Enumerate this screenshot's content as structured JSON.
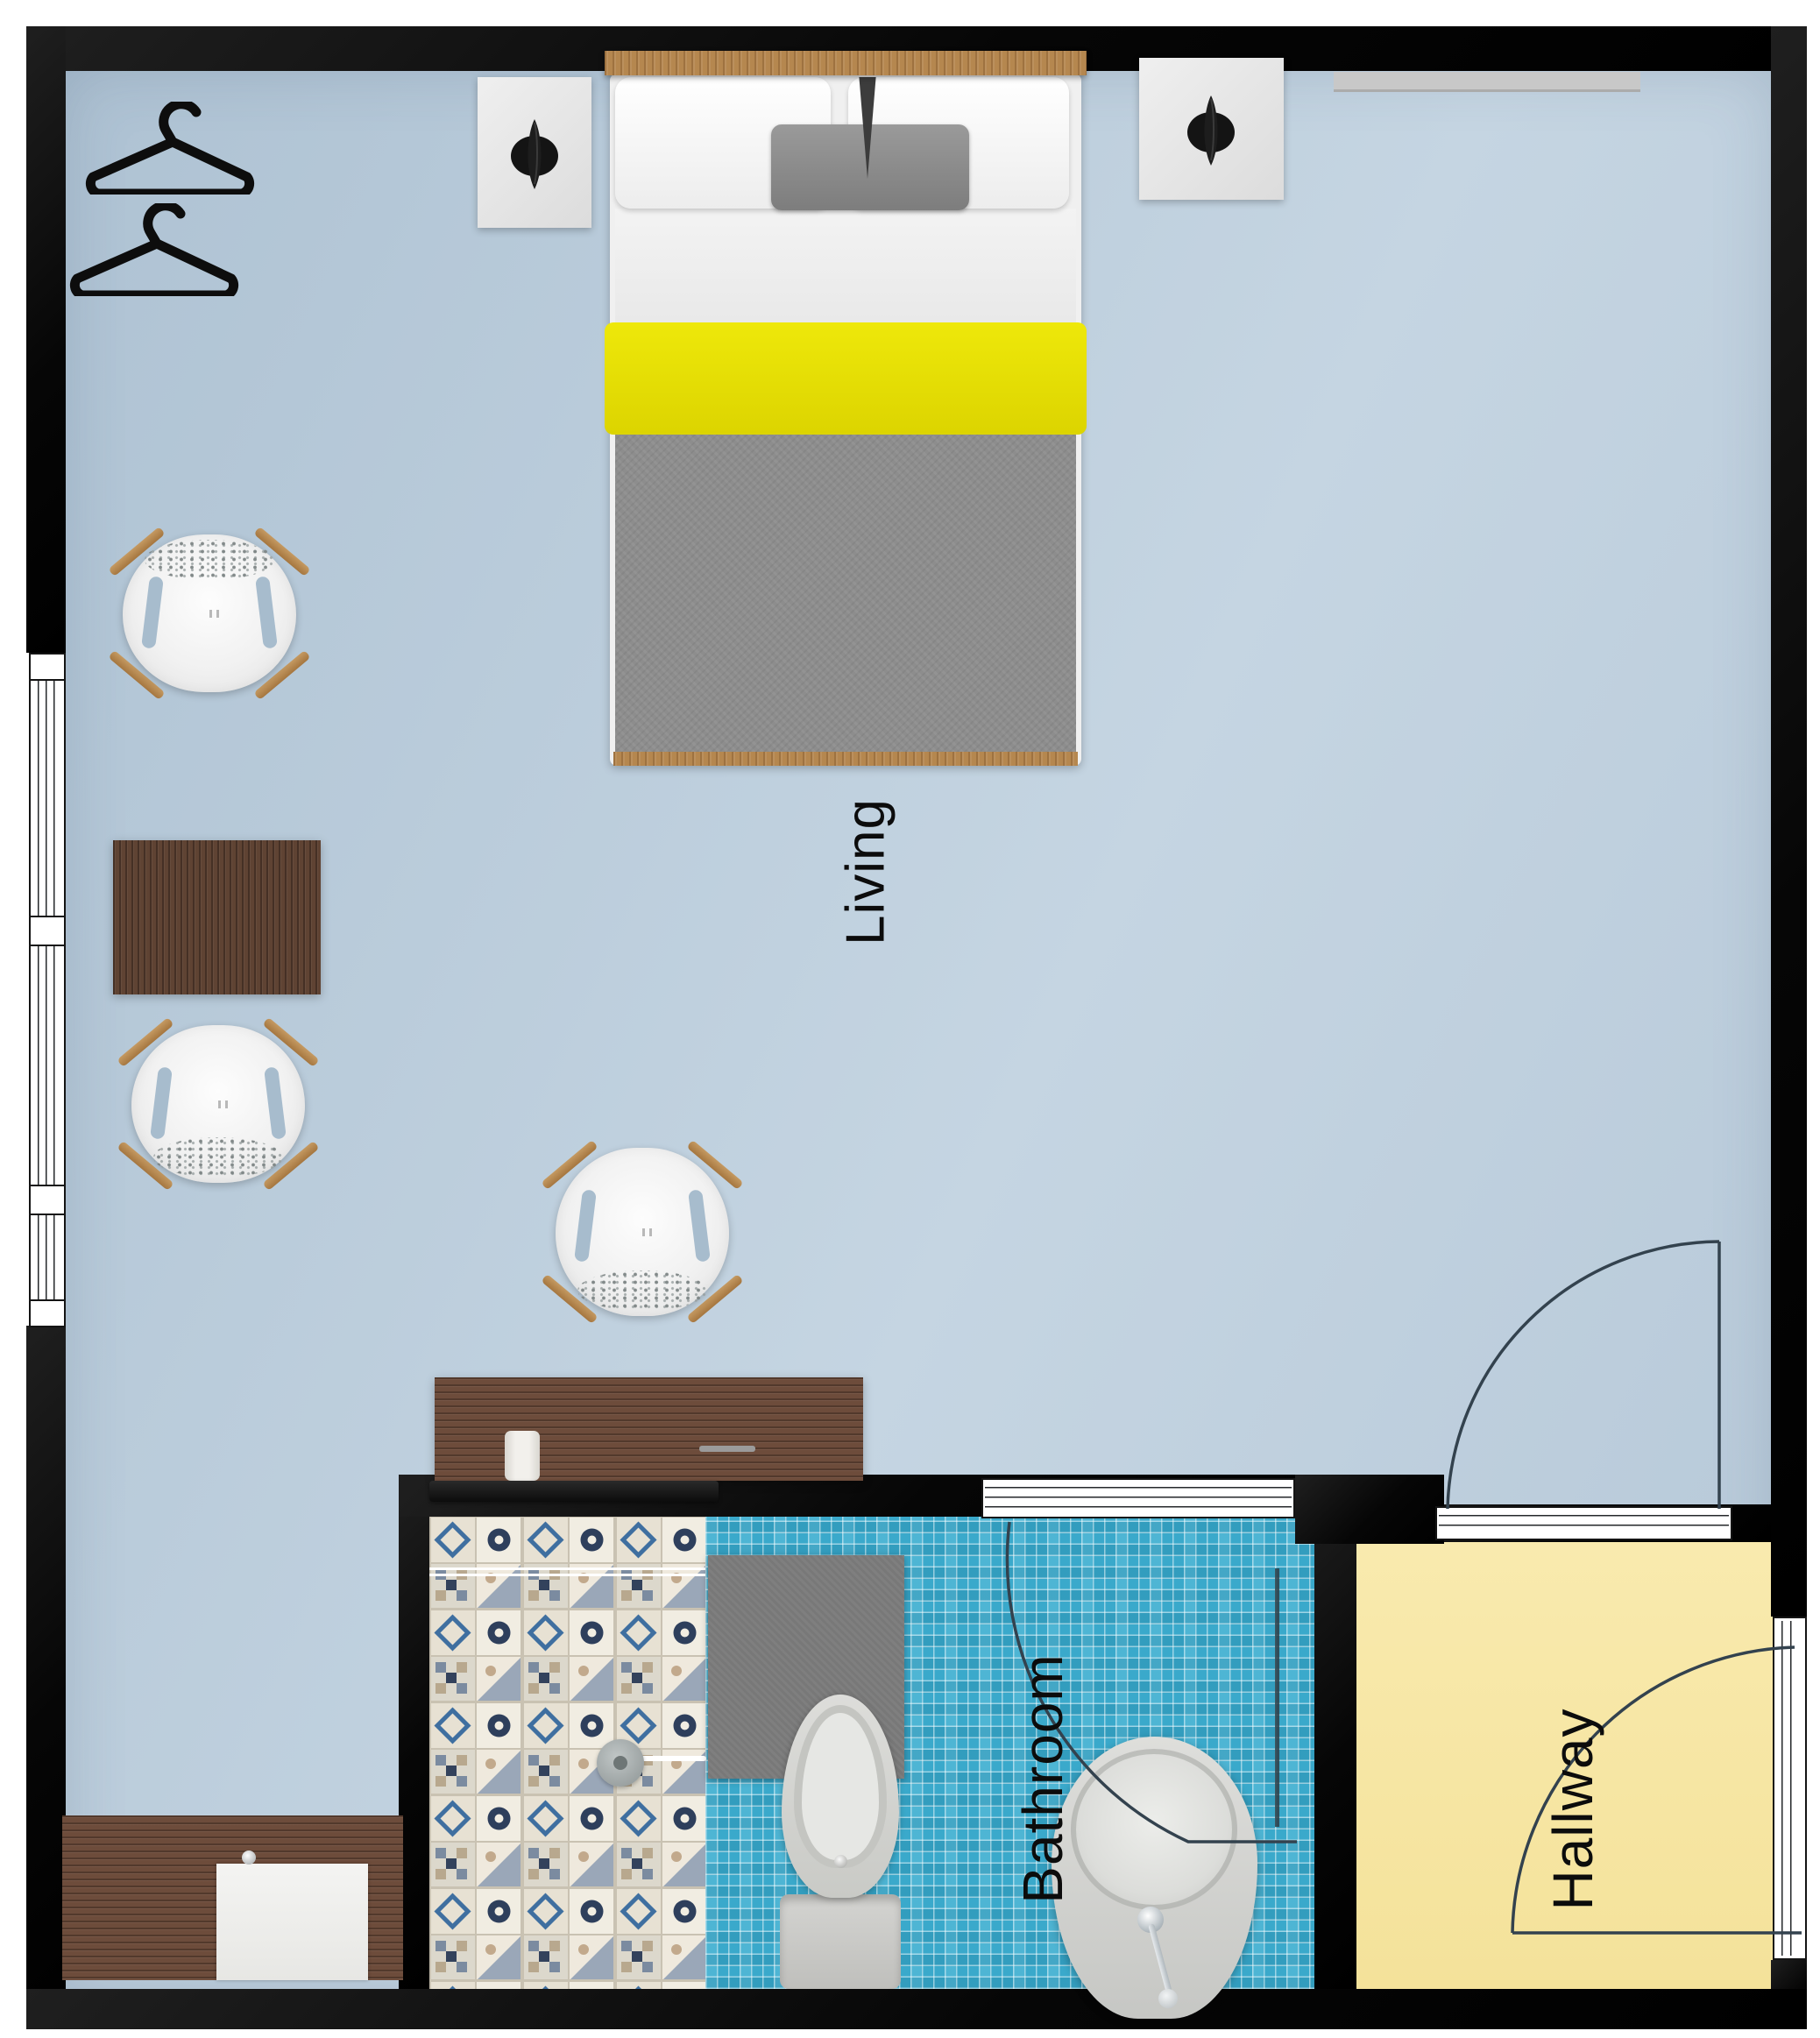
{
  "floorplan": {
    "rooms": [
      {
        "id": "living",
        "label": "Living"
      },
      {
        "id": "bathroom",
        "label": "Bathroom"
      },
      {
        "id": "hallway",
        "label": "Hallway"
      }
    ],
    "palette": {
      "wall": "#0d0d0d",
      "living_floor": "#b9cbda",
      "hallway_floor": "#f8e9aa",
      "bathroom_mosaic_tile": "#3aa9cb",
      "shower_tile_base": "#e9e4d8",
      "bed_accent_yellow": "#e8e103",
      "duvet_gray": "#8d8d8d",
      "wood_dark": "#6a4a3a",
      "wood_light": "#b5874f",
      "bath_mat_gray": "#787878"
    },
    "icons": [
      {
        "name": "hanger-icon",
        "count": 2
      },
      {
        "name": "table-lamp-icon",
        "count": 2
      },
      {
        "name": "shower-head-icon",
        "count": 1
      },
      {
        "name": "toilet-icon",
        "count": 1
      },
      {
        "name": "sink-icon",
        "count": 1
      },
      {
        "name": "door-swing-arc-icon",
        "count": 3
      },
      {
        "name": "window-icon",
        "count": 1
      }
    ],
    "furniture": [
      "double-bed",
      "nightstand-left",
      "nightstand-right",
      "lounge-chair-top-left",
      "lounge-chair-bottom-left",
      "lounge-chair-center",
      "side-table",
      "desk",
      "tv",
      "wall-shelf",
      "kitchenette-counter",
      "counter-appliance",
      "bath-mat",
      "towel-rail"
    ]
  }
}
